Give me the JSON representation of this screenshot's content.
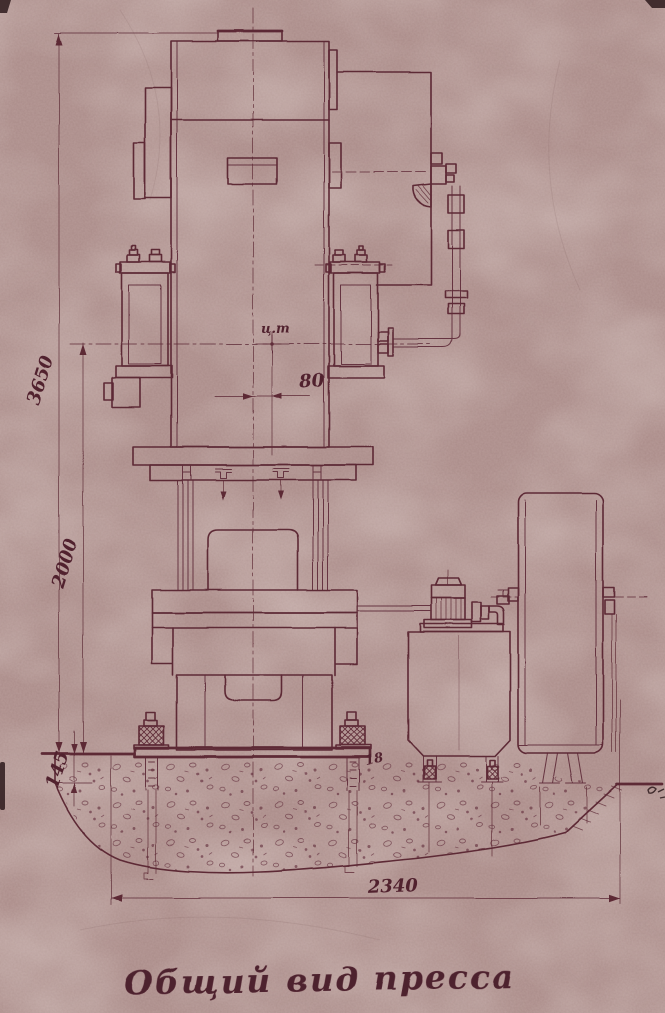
{
  "title": {
    "text": "Общий вид пресса"
  },
  "dimensions": {
    "total_height": "3650",
    "working_height": "2000",
    "foundation_step": "145",
    "cg_offset": "80",
    "foundation_width": "2340"
  },
  "annotations": {
    "center_of_gravity": "ц.т",
    "anchor_bolt": "18"
  },
  "colors": {
    "paper": "#b79a97",
    "ink": "#5d2936"
  }
}
